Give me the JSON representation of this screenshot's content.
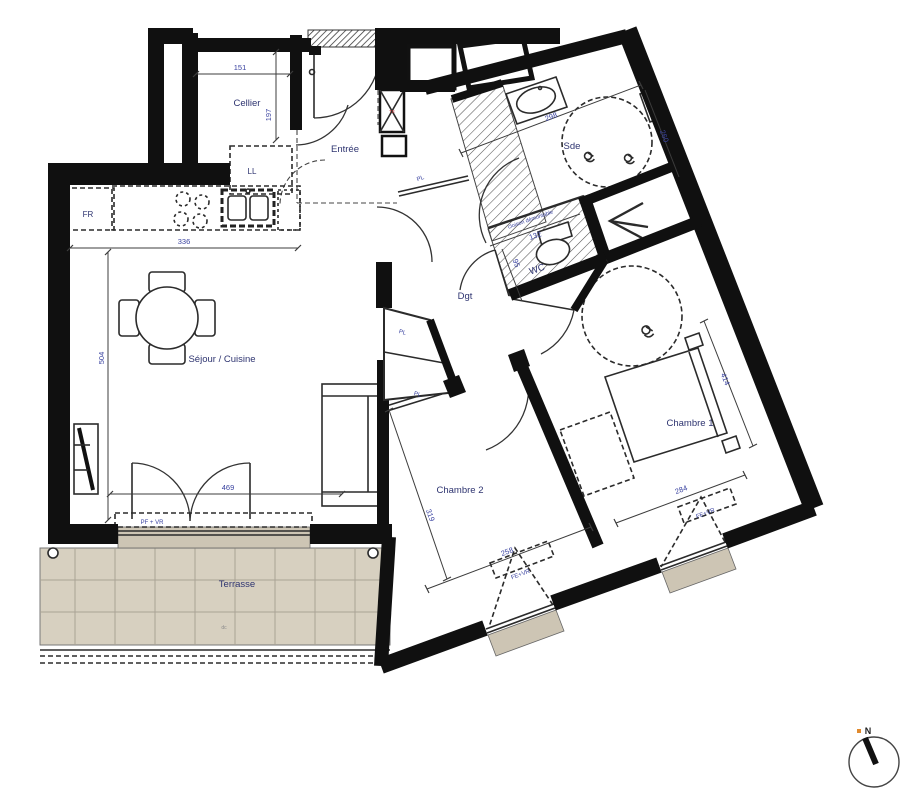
{
  "rooms": {
    "cellier": "Cellier",
    "entree": "Entrée",
    "sde": "Sde",
    "wc": "WC",
    "dgt": "Dgt",
    "sejour": "Séjour / Cuisine",
    "chambre1": "Chambre 1",
    "chambre2": "Chambre 2",
    "terrasse": "Terrasse"
  },
  "dimensions": {
    "cellier_w": "151",
    "cellier_h": "197",
    "kitchen_w": "336",
    "sejour_h": "504",
    "sejour_w": "469",
    "sde_w": "298",
    "sde_h": "260",
    "wc_w": "132",
    "wc_h": "95",
    "chambre1_l": "414",
    "chambre1_w": "284",
    "chambre2_l": "319",
    "chambre2_w": "258"
  },
  "annotations": {
    "fridge": "FR",
    "washing_machine": "LL",
    "closet": "PL",
    "removable_partition": "cloison démontable",
    "french_door_shutter": "PF + VR",
    "window_shutter": "FE+VR",
    "terrace_note": "dc",
    "technical_duct": "TE",
    "north": "N"
  },
  "colors": {
    "wall": "#101010",
    "dimension_text": "#3a43a0",
    "room_text": "#2e3470",
    "terrace_fill": "#d7d0c0",
    "sill_fill": "#cdc5b4",
    "hatch_line": "#555555"
  }
}
